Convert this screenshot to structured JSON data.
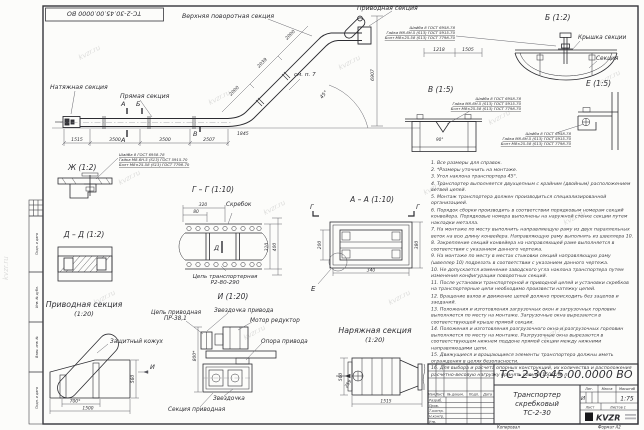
{
  "sheet": {
    "stamp": "ТС-2-30.45.00.0000 ВО",
    "wm": "kvzr.ru",
    "copied": "Копировал",
    "format": "Формат А2"
  },
  "fs": {
    "l1": "Шайба 8 ГОСТ 6958-78",
    "l2": "Гайка М8-6Н.5 (S13) ГОСТ 5915-70",
    "l3": "Болт М8×25.58 (S13) ГОСТ 7798-70"
  },
  "mv": {
    "l_top": "Верхняя поворотная секция",
    "l_drive": "Приводная секция",
    "l_tension": "Натяжная секция",
    "l_straight": "Прямая секция",
    "see": "см. п. 7",
    "angle": "45°",
    "mA": "А",
    "mB": "Б",
    "mV": "В",
    "d1": "1515",
    "d2": "3500",
    "d3": "3500",
    "d4": "2507",
    "d5": "1845",
    "s1": "2000",
    "s2": "2039",
    "s3": "2000",
    "t1": "1218",
    "t2": "1505",
    "h1": "6907"
  },
  "vb": {
    "t": "Б (1:2)",
    "cover": "Крышка секции",
    "section": "Секция"
  },
  "vv": {
    "t": "В (1:5)",
    "dim": "90°"
  },
  "ve": {
    "t": "Е (1:5)"
  },
  "vzh": {
    "t": "Ж (1:2)"
  },
  "vgg": {
    "t": "Г – Г (1:10)",
    "scraper": "Скребок",
    "chain1": "Цепь транспортерная",
    "chain2": "Р2-80-290",
    "mD": "Д",
    "w1": "320",
    "w2": "80",
    "h1": "310",
    "h2": "400"
  },
  "vdd": {
    "t": "Д – Д (1:2)"
  },
  "vaa": {
    "t": "А – А (1:10)",
    "mG": "Г",
    "mE": "Е",
    "dl": "200",
    "dr": "380",
    "db": "340"
  },
  "vdr": {
    "t1": "Приводная секция",
    "t2": "(1:20)",
    "cover": "Защитный кожух",
    "chain1": "Цепь приводная",
    "chain2": "ПР-38,1",
    "d1": "700*",
    "d2": "1500",
    "d3": "560",
    "mI": "И"
  },
  "vi": {
    "t": "И (1:20)",
    "spr_drive": "Звездочка привода",
    "motor": "Мотор редуктор",
    "support": "Опора привода",
    "spr": "Звездочка",
    "section": "Секция приводная",
    "d1": "800*"
  },
  "vt": {
    "t1": "Наряжная секция",
    "t2": "(1:20)",
    "d1": "560",
    "d2": "259",
    "d3": "1515"
  },
  "notes": {
    "items": [
      "1. Все размеры для справок.",
      "2. *Размеры уточнить на монтаже.",
      "3. Угол наклона транспортера 45°.",
      "4. Транспортер выполняется двухцепным с крайним (двойным) расположением ветвей цепей.",
      "5. Монтаж транспортера должен производиться специализированной организацией.",
      "6. Порядок сборки производить в соответствии порядковым номерам секций конвейера. Порядковые номера выполнены на наружной стенке секции путем накладки металла.",
      "7. На монтаже по месту выполнить направляющую раму из двух параллельных веток на всю длину конвейера. Направляющую раму выполнять из швеллера 10.",
      "8. Закрепление секций конвейера на направляющей раме выполняется в соответствии с указанием данного чертежа.",
      "9. На монтаже по месту в местах стыковки секций направляющую раму (швеллер 10) подрезать в соответствии с указанием данного чертежа.",
      "10. Не допускается изменение заводского угла наклона транспортера путем изменения конфигурации поворотных секций.",
      "11. После установки транспортерной и приводной цепей и установки скребков на транспортерные цепи необходимо произвести натяжку цепей.",
      "12. Вращение валов и движение цепей должно происходить без зацепов и заеданий.",
      "13. Положения и изготовления загрузочных окон и загрузочных горловин выполняется по месту на монтаже. Загрузочные окна вырезаются в соответствующей крыше прямой секции.",
      "14. Положения и изготовления разгрузочного окна и разгрузочных горловин выполняется по месту на монтаже. Разгрузочные окна вырезаются в соответствующем нижнем поддоне прямой секции между нижними направляющими цепи.",
      "15. Движущиеся и вращающиеся элементы транспортера должны иметь ограждения в целях безопасности.",
      "16. Для выбора и расчета опорных конструкций, их количества и расположения расчетно-весовую нагрузку принять равной 150кг/м. п."
    ]
  },
  "tb": {
    "num": "ТС -2-30.45.00.0000  ВО",
    "n1": "Транспортер",
    "n2": "скребковый",
    "n3": "ТС-2-30",
    "scale": "1:75",
    "lit": "И",
    "hLit": "Лит.",
    "hMass": "Масса",
    "hScale": "Масштаб",
    "sheet": "Лист",
    "sheets": "Листов 1",
    "r1": "Разраб.",
    "r2": "Пров.",
    "r3": "Т.контр.",
    "r4": "Н.контр.",
    "r5": "Утв.",
    "c1": "Изм.",
    "c2": "Лист",
    "c3": "№ докум.",
    "c4": "Подп.",
    "c5": "Дата",
    "logo": "KVZR"
  },
  "frame": {
    "s1": "Подп. и дата",
    "s2": "Инв. № дубл.",
    "s3": "Взам. инв. №",
    "s4": "Подп. и дата",
    "s5": "Инв. № подл."
  }
}
